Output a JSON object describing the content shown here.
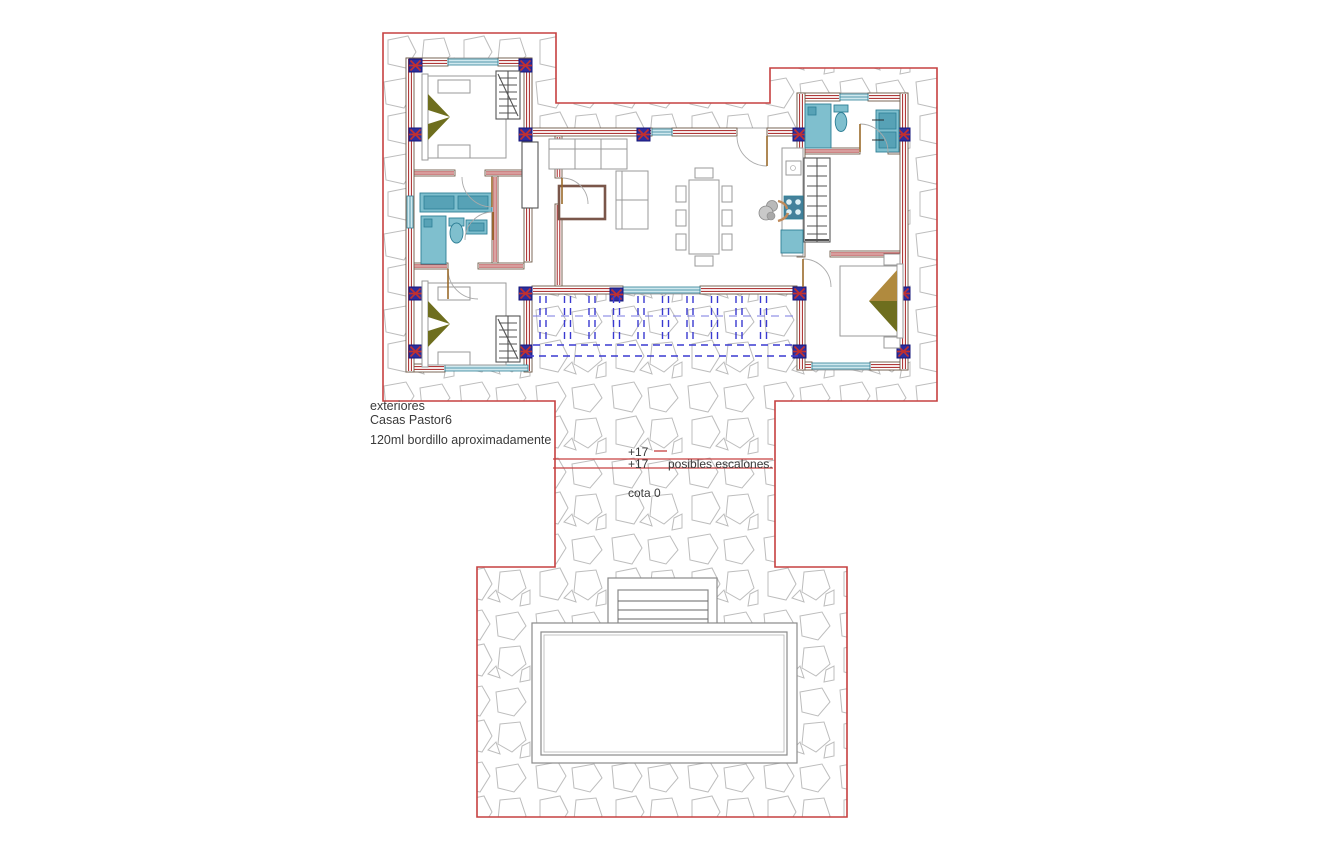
{
  "drawing": {
    "labels": {
      "exteriores": "exteriores",
      "project": "Casas Pastor6",
      "bordillo": "120ml bordillo aproximadamente",
      "level_a": "+17",
      "level_b": "+17",
      "steps_note": "posibles escalones.",
      "ground": "cota 0"
    },
    "colors": {
      "boundary_red": "#c64040",
      "wall_hatch_red": "#b03a3a",
      "wall_edge": "#6e5a48",
      "column_blue": "#2e2e9e",
      "column_cross_red": "#c03030",
      "fixture_teal": "#7fbfce",
      "fixture_teal_dark": "#2e7f96",
      "stove_teal": "#44819b",
      "pergola_blue": "#3a3ad0",
      "stone_gray": "#bdbdbd",
      "furniture_gray": "#9a9a9a",
      "door_wood": "#9a6a2a",
      "bed_olive": "#6e6e1e",
      "bed_tan": "#b08a3e",
      "rug_brown": "#7a564a",
      "pool_line": "#8a8a8a",
      "text_dark": "#3a3a3a"
    }
  }
}
